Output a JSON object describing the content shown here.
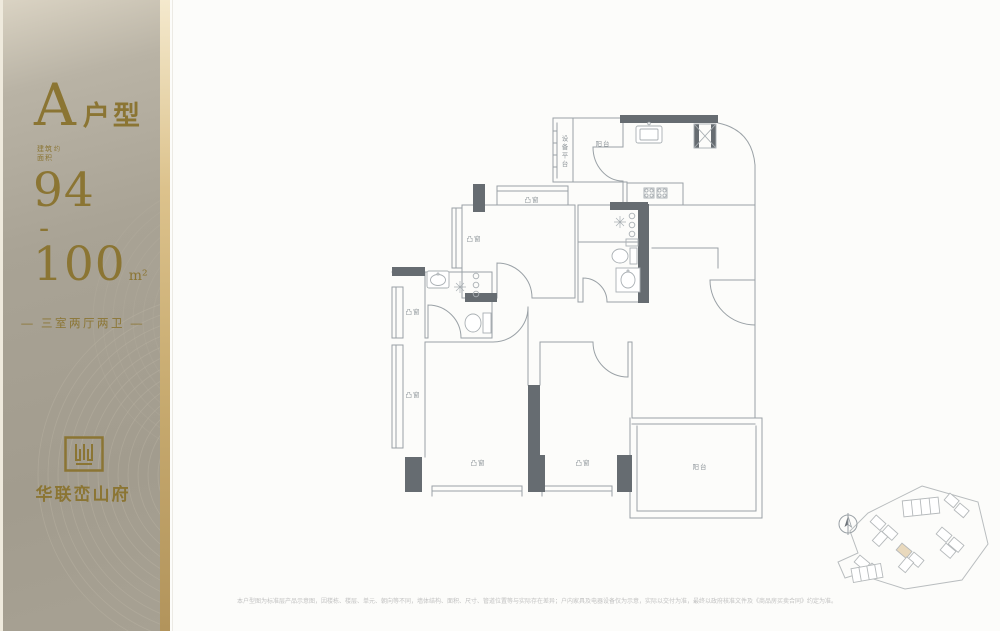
{
  "sidebar": {
    "unit_letter": "A",
    "unit_suffix": "户型",
    "area_label": {
      "l1": "建筑",
      "l2": "面积",
      "approx": "约"
    },
    "area_from": "94",
    "area_dash": "-",
    "area_to": "100",
    "area_unit": "m²",
    "layout_line": "— 三室两厅两卫 —",
    "brand_name": "华联峦山府",
    "colors": {
      "gold": "#8b7533",
      "background": "#a9a395",
      "gold_strip": "#c6a96e"
    }
  },
  "floorplan": {
    "labels": [
      {
        "text": "设备平台",
        "x": 563,
        "y": 152,
        "vertical": true
      },
      {
        "text": "阳台",
        "x": 603,
        "y": 143
      },
      {
        "text": "凸窗",
        "x": 532,
        "y": 199
      },
      {
        "text": "凸窗",
        "x": 474,
        "y": 238
      },
      {
        "text": "凸窗",
        "x": 413,
        "y": 311
      },
      {
        "text": "凸窗",
        "x": 413,
        "y": 394
      },
      {
        "text": "凸窗",
        "x": 478,
        "y": 462
      },
      {
        "text": "凸窗",
        "x": 583,
        "y": 462
      },
      {
        "text": "阳台",
        "x": 700,
        "y": 466
      }
    ],
    "colors": {
      "wall_line": "#9aa1a6",
      "wall_fill": "#666c71",
      "label": "#8f969b"
    }
  },
  "footer": {
    "disclaimer": "本户型图为标准层产品示意图，因楼栋、楼层、单元、朝向等不同，墙体结构、面积、尺寸、管道位置等与实际存在差异；户内家具及电器设备仅为示意，实际以交付为准，最终以政府核准文件及《商品房买卖合同》约定为准。"
  }
}
